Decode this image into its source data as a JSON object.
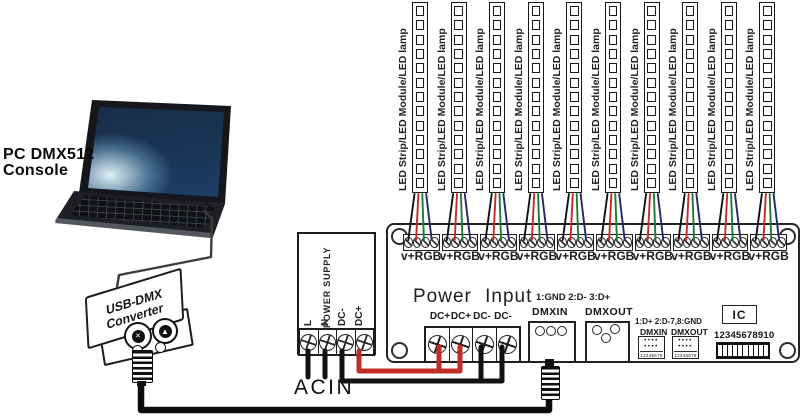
{
  "console": {
    "label_line1": "PC  DMX512",
    "label_line2": "Console"
  },
  "converter": {
    "line1": "USB-DMX",
    "line2": "Converter"
  },
  "power_supply": {
    "title": "POWER SUPPLY",
    "terminals": [
      "L",
      "N",
      "DC-",
      "DC+"
    ],
    "acin": "ACIN"
  },
  "board": {
    "power_input_title": "Power Input",
    "power_terminals": [
      "DC+",
      "DC+",
      "DC-",
      "DC-"
    ],
    "dmx_primary": {
      "pinout": "1:GND 2:D- 3:D+",
      "in": "DMXIN",
      "out": "DMXOUT"
    },
    "dmx_rj45": {
      "pinout": "1:D+ 2:D-7,8:GND",
      "in": "DMXIN",
      "out": "DMXOUT",
      "pins": "12345678"
    },
    "ic": "IC",
    "dip": {
      "numbers": "12345678910",
      "positions": 10
    },
    "output_label": "v+RGB",
    "output_count": 10
  },
  "strips": {
    "label": "LED Strip/LED Module/LED lamp",
    "count": 10,
    "cells": 13
  },
  "icons": {
    "xlr_female": "✕",
    "xlr_lock": "▲",
    "jack_dots": "••••"
  },
  "colors": {
    "wire_black": "#121212",
    "wire_red": "#c12d24",
    "wire_green": "#1e7a38",
    "wire_blue": "#232a63",
    "cable": "#0c0c0c",
    "thin_cable": "#3c3c3c"
  }
}
